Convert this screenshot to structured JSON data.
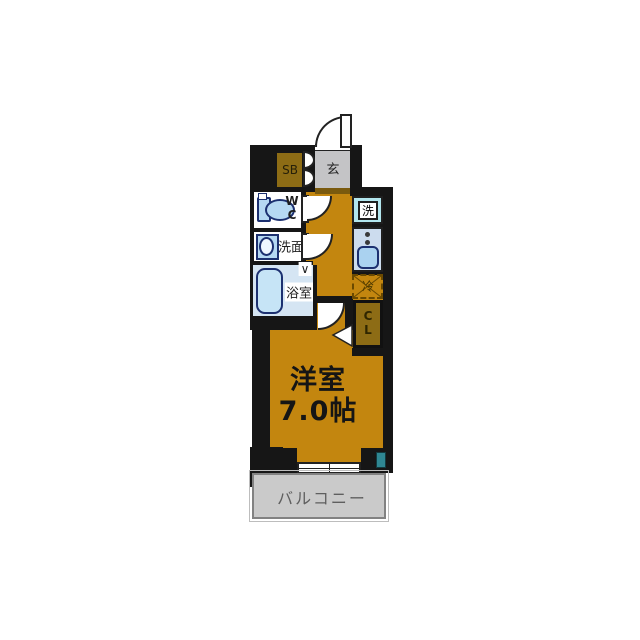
{
  "plan": {
    "type": "apartment-floor-plan",
    "labels": {
      "entrance": "玄",
      "shoe_box": "SB",
      "wc_w": "W",
      "wc_c": "C",
      "washroom": "洗面",
      "bathroom": "浴室",
      "washer": "洗",
      "fridge": "冷",
      "closet_c": "C",
      "closet_l": "L",
      "room_name": "洋室",
      "room_size": "7.0帖",
      "balcony": "バルコニー",
      "folding_door_mark": "∨"
    },
    "colors": {
      "floor_orange": "#c3860f",
      "wall_black": "#161616",
      "entrance_gray": "#c4c4c6",
      "entrance_step_brown": "#7a5a0e",
      "balcony_gray": "#cacaca",
      "cabinet_olive": "#8d6c15",
      "fixture_blue": "#b5d8f2",
      "fixture_outline_navy": "#1c3070",
      "washer_cyan": "#b2e6ee",
      "kitchen_blue": "#ccdcee",
      "bathroom_blue": "#d5e5f3",
      "window_teal": "#2f8793"
    }
  }
}
